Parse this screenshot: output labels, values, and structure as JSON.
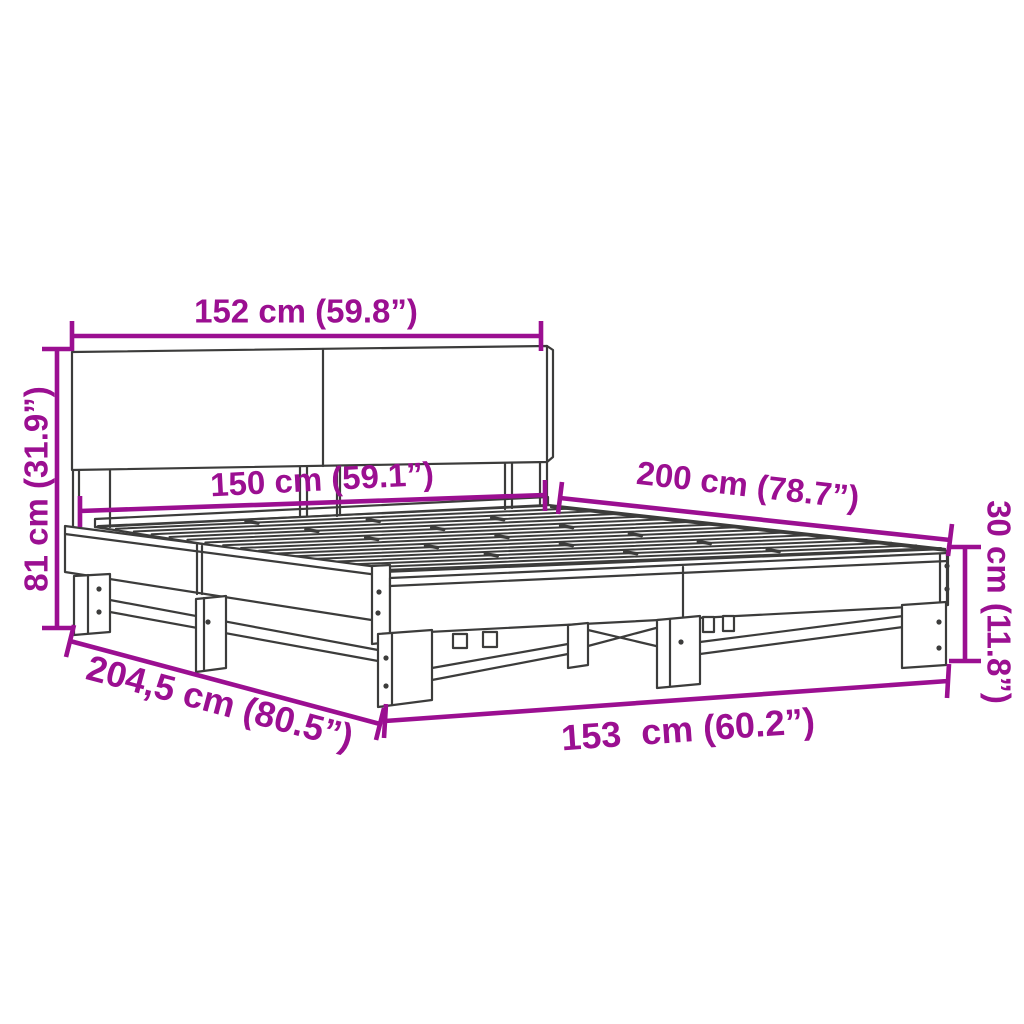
{
  "diagram": {
    "subject": "bed-frame-dimension-diagram",
    "background_color": "#ffffff",
    "accent_color": "#9B0F91",
    "line_color": "#3C3C3B",
    "dimensions": {
      "width_top": "152 cm (59.8”)",
      "height_left": "81 cm (31.9”)",
      "width_inner": "150 cm (59.1”)",
      "length_right": "200 cm (78.7”)",
      "height_right": "30 cm (11.8”)",
      "length_bottom": "204,5 cm (80.5”)",
      "width_bottom": "153  cm (60.2”)"
    }
  }
}
